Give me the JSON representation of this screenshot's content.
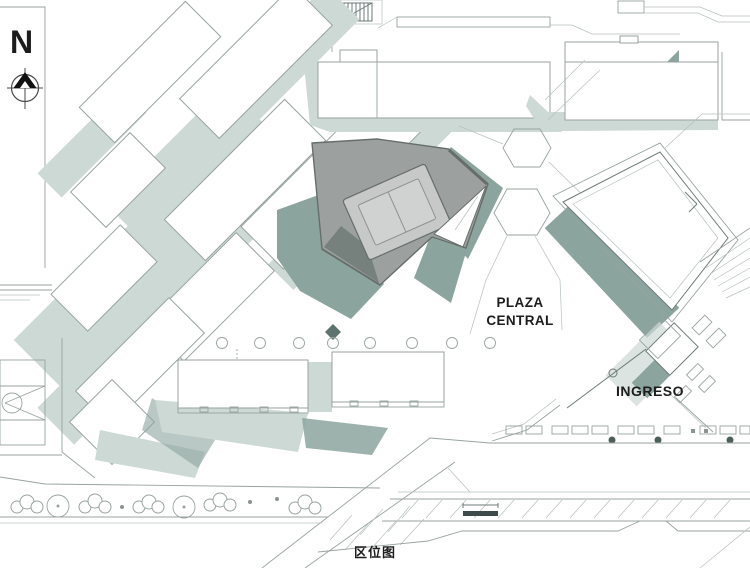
{
  "caption": "区位图",
  "compass": {
    "label": "N",
    "icon": "north-arrow"
  },
  "labels": {
    "plaza_central": "PLAZA\nCENTRAL",
    "ingreso": "INGRESO"
  },
  "colors": {
    "background": "#ffffff",
    "line": "#98a3a0",
    "line-light": "#b6c0bd",
    "line-dark": "#6e7a77",
    "sage": "#cdd9d5",
    "teal": "#8ca49e",
    "teal-dark": "#5e736e",
    "roof": "#9ca19f",
    "court": "#c6c9c7",
    "court-inner": "#cfd2d0",
    "edge": "#666e6a",
    "shadow-dark": "#76817e",
    "tree-dark": "#4c5f5a",
    "ink": "#1c1c1c"
  }
}
